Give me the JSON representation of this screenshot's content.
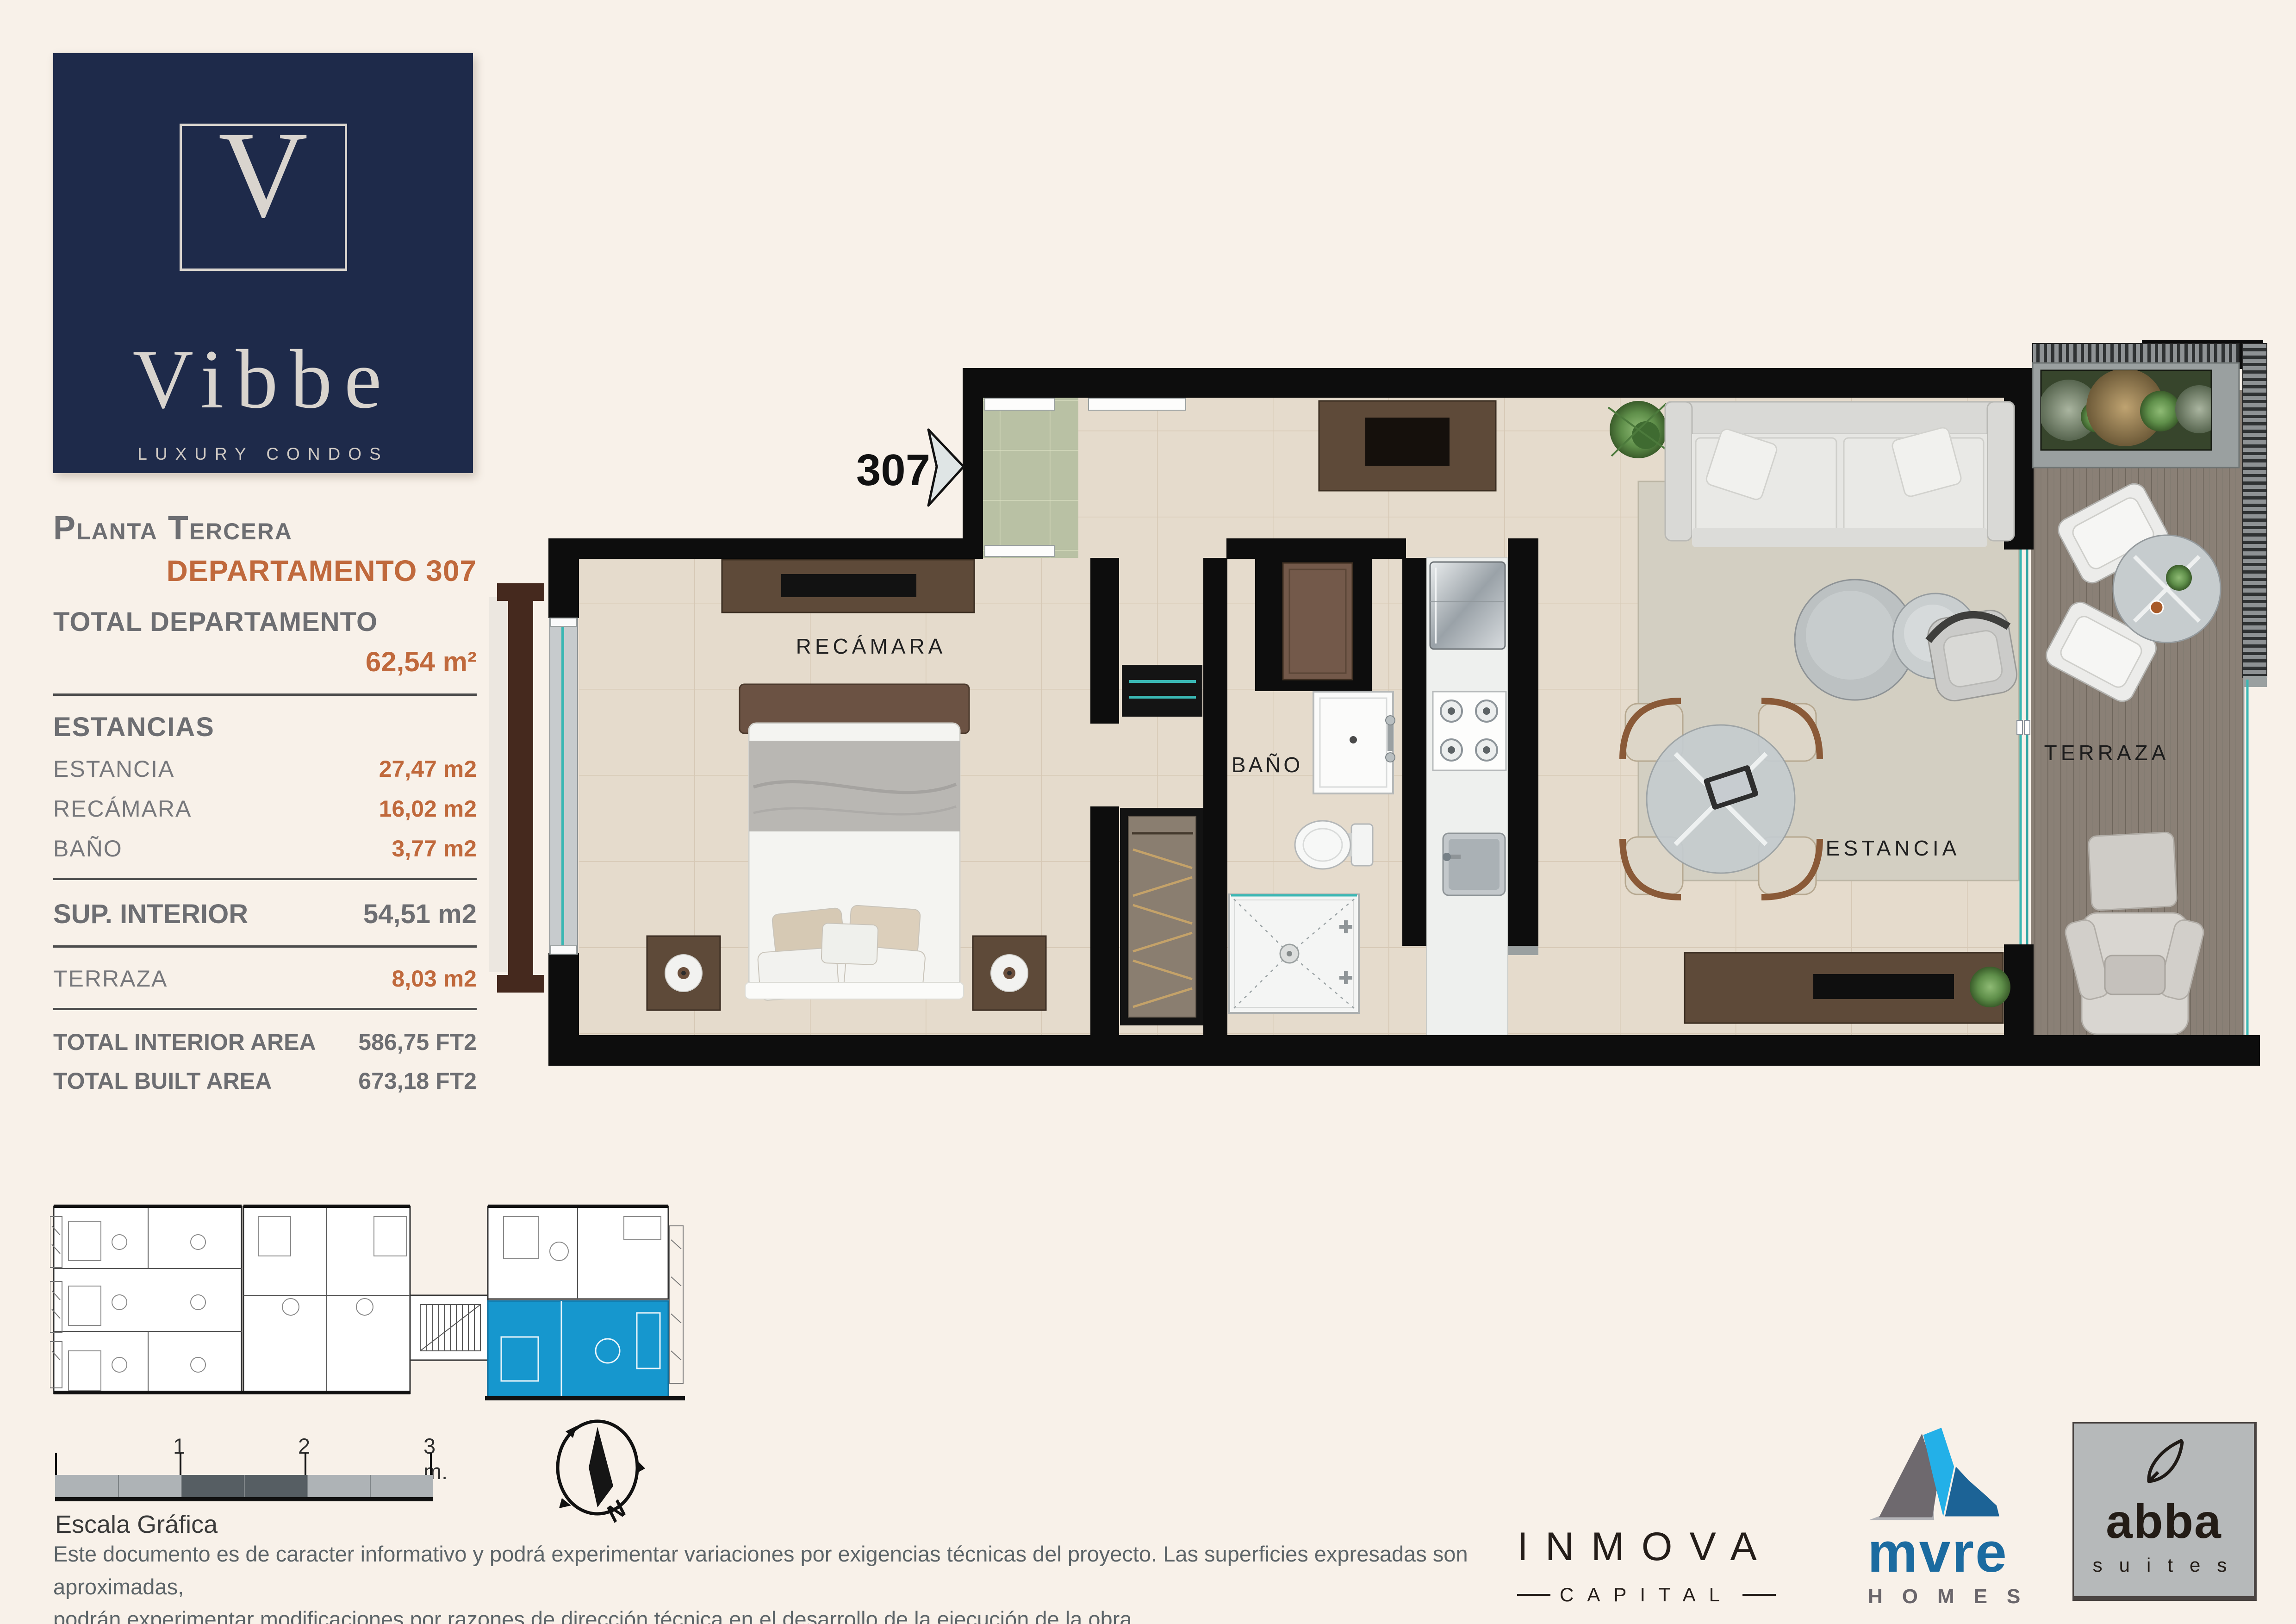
{
  "brand": {
    "initial": "V",
    "name": "Vibbe",
    "tagline": "LUXURY CONDOS"
  },
  "sidebar": {
    "floor_title": "Planta Tercera",
    "unit_title": "DEPARTAMENTO 307",
    "total_label": "TOTAL DEPARTAMENTO",
    "total_value": "62,54 m²",
    "rooms_heading": "ESTANCIAS",
    "rooms": [
      {
        "label": "ESTANCIA",
        "value": "27,47 m2"
      },
      {
        "label": "RECÁMARA",
        "value": "16,02 m2"
      },
      {
        "label": "BAÑO",
        "value": "3,77 m2"
      }
    ],
    "interior_label": "SUP. INTERIOR",
    "interior_value": "54,51 m2",
    "terrace_label": "TERRAZA",
    "terrace_value": "8,03 m2",
    "totals": [
      {
        "label": "TOTAL INTERIOR AREA",
        "value": "586,75 FT2"
      },
      {
        "label": "TOTAL BUILT AREA",
        "value": "673,18 FT2"
      }
    ]
  },
  "plan": {
    "unit_number": "307",
    "bedroom_label": "RECÁMARA",
    "bath_label": "BAÑO",
    "living_label": "ESTANCIA",
    "terrace_label": "TERRAZA"
  },
  "scalebar": {
    "tick1": "1",
    "tick2": "2",
    "tick3": "3 m.",
    "caption": "Escala Gráfica"
  },
  "compass": {
    "north": "N"
  },
  "disclaimer": {
    "line1": "Este documento es de caracter informativo y podrá experimentar variaciones por exigencias técnicas del proyecto. Las superficies expresadas son aproximadas,",
    "line2": "podrán experimentar modificaciones por razones de dirección técnica en el desarrollo de la ejecución de la obra."
  },
  "partners": {
    "inmova": {
      "name": "INMOVA",
      "sub": "CAPITAL"
    },
    "mvre": {
      "name": "mvre",
      "sub": "HOMES"
    },
    "abba": {
      "name": "abba",
      "sub": "suites"
    }
  },
  "colors": {
    "background": "#f8f1e9",
    "navy": "#1e2a4a",
    "orange": "#c0693c",
    "text_gray": "#6f7276",
    "wall_black": "#0d0d0d",
    "floor_beige": "#e5dbcc",
    "vestibule_green": "#b9c1a4",
    "deck_wood": "#8a8076",
    "glass_teal": "#3ab7b3",
    "highlight_blue": "#1697ce"
  }
}
